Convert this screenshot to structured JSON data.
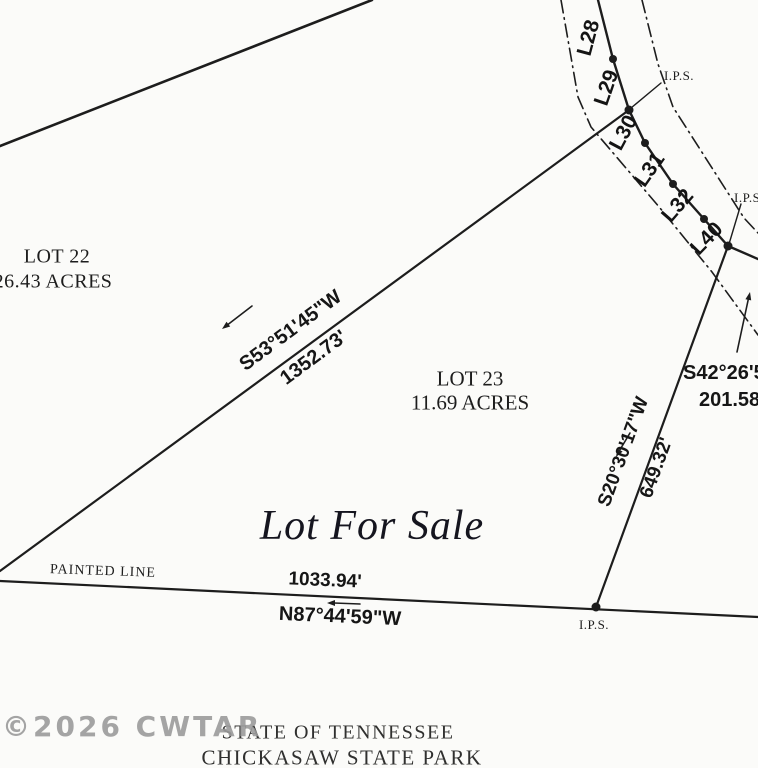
{
  "plat": {
    "watermark": "©2026 CWTAR",
    "sale_label": "Lot For Sale",
    "painted_line_label": "PAINTED LINE",
    "footer": {
      "line1": "STATE OF TENNESSEE",
      "line2": "CHICKASAW STATE PARK"
    },
    "lots": {
      "lot22": {
        "name": "LOT 22",
        "acreage": "26.43 ACRES"
      },
      "lot23": {
        "name": "LOT 23",
        "acreage": "11.69 ACRES"
      }
    },
    "dimensions": {
      "west": {
        "bearing": "S53°51'45\"W",
        "distance": "1352.73'"
      },
      "east": {
        "bearing": "S20°30'17\"W",
        "distance": "649.32'"
      },
      "south": {
        "bearing": "N87°44'59\"W",
        "distance": "1033.94'"
      },
      "northeast": {
        "bearing": "S42°26'5",
        "distance": "201.58"
      }
    },
    "road": {
      "segments": [
        "L28",
        "L29",
        "L30",
        "L31",
        "L32",
        "L40"
      ]
    },
    "markers": {
      "ips_top": "I.P.S.",
      "ips_right": "I.P.S.",
      "ips_bottom": "I.P.S."
    },
    "colors": {
      "ink": "#1d1d1d",
      "paper": "#fbfbf9",
      "watermark": "#9b9b9b"
    }
  }
}
